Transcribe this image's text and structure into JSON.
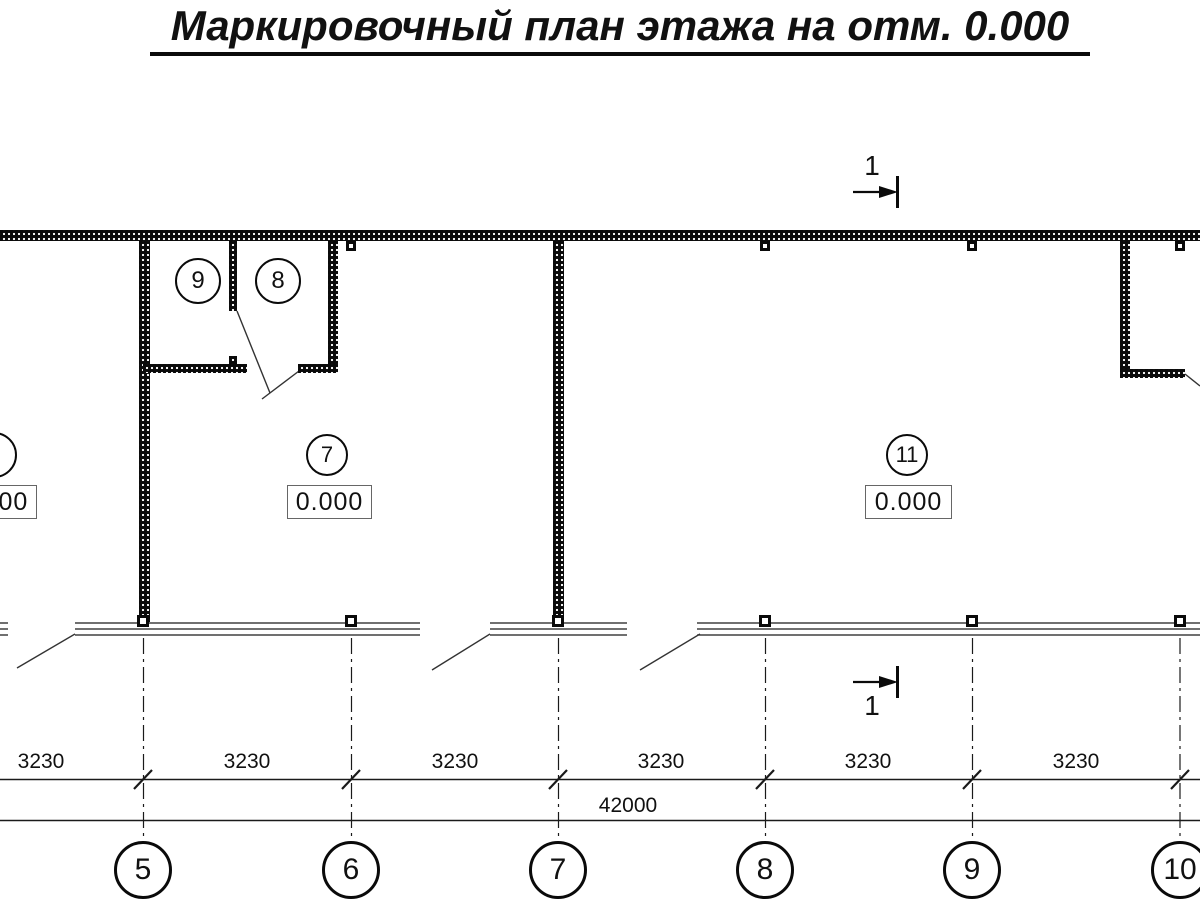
{
  "title": "Маркировочный план этажа на отм. 0.000",
  "section_marks": {
    "top": {
      "label": "1"
    },
    "bottom": {
      "label": "1"
    }
  },
  "rooms": {
    "room9": {
      "number": "9"
    },
    "room8": {
      "number": "8"
    },
    "room7": {
      "number": "7",
      "elevation": "0.000"
    },
    "room11": {
      "number": "11",
      "elevation": "0.000"
    },
    "room_left_partial": {
      "elevation": "0.000"
    }
  },
  "dimensions": {
    "segments": [
      "3230",
      "3230",
      "3230",
      "3230",
      "3230",
      "3230"
    ],
    "total": "42000"
  },
  "axes": [
    "5",
    "6",
    "7",
    "8",
    "9",
    "10"
  ]
}
